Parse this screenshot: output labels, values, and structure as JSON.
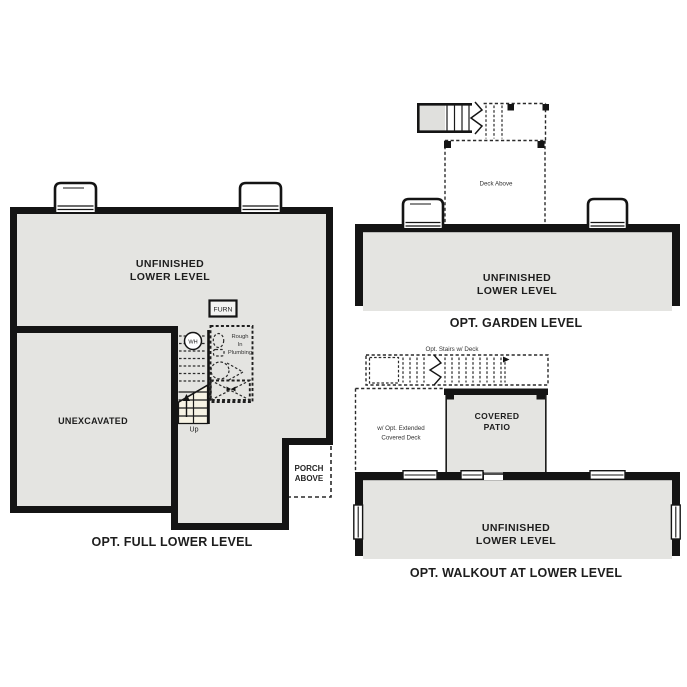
{
  "colors": {
    "background": "#ffffff",
    "room_fill": "#e4e4e1",
    "wall": "#141414",
    "stair_fill": "#f7f3e4",
    "dashed_line": "#2a2a2a",
    "label_text": "#1d1d1d"
  },
  "plans": {
    "full": {
      "title": "OPT. FULL LOWER LEVEL",
      "room_label": {
        "line1": "UNFINISHED",
        "line2": "LOWER LEVEL"
      },
      "unexcavated": "UNEXCAVATED",
      "furn": "FURN",
      "wh": "WH",
      "rough_in": {
        "line1": "Rough",
        "line2": "In",
        "line3": "Plumbing"
      },
      "up": "Up",
      "porch": {
        "line1": "PORCH",
        "line2": "ABOVE"
      }
    },
    "garden": {
      "title": "OPT. GARDEN LEVEL",
      "room_label": {
        "line1": "UNFINISHED",
        "line2": "LOWER LEVEL"
      },
      "deck_above": "Deck Above"
    },
    "walkout": {
      "title": "OPT. WALKOUT AT LOWER LEVEL",
      "room_label": {
        "line1": "UNFINISHED",
        "line2": "LOWER LEVEL"
      },
      "opt_stairs": "Opt. Stairs w/ Deck",
      "ext_deck": {
        "line1": "w/ Opt. Extended",
        "line2": "Covered Deck"
      },
      "covered_patio": {
        "line1": "COVERED",
        "line2": "PATIO"
      }
    }
  }
}
